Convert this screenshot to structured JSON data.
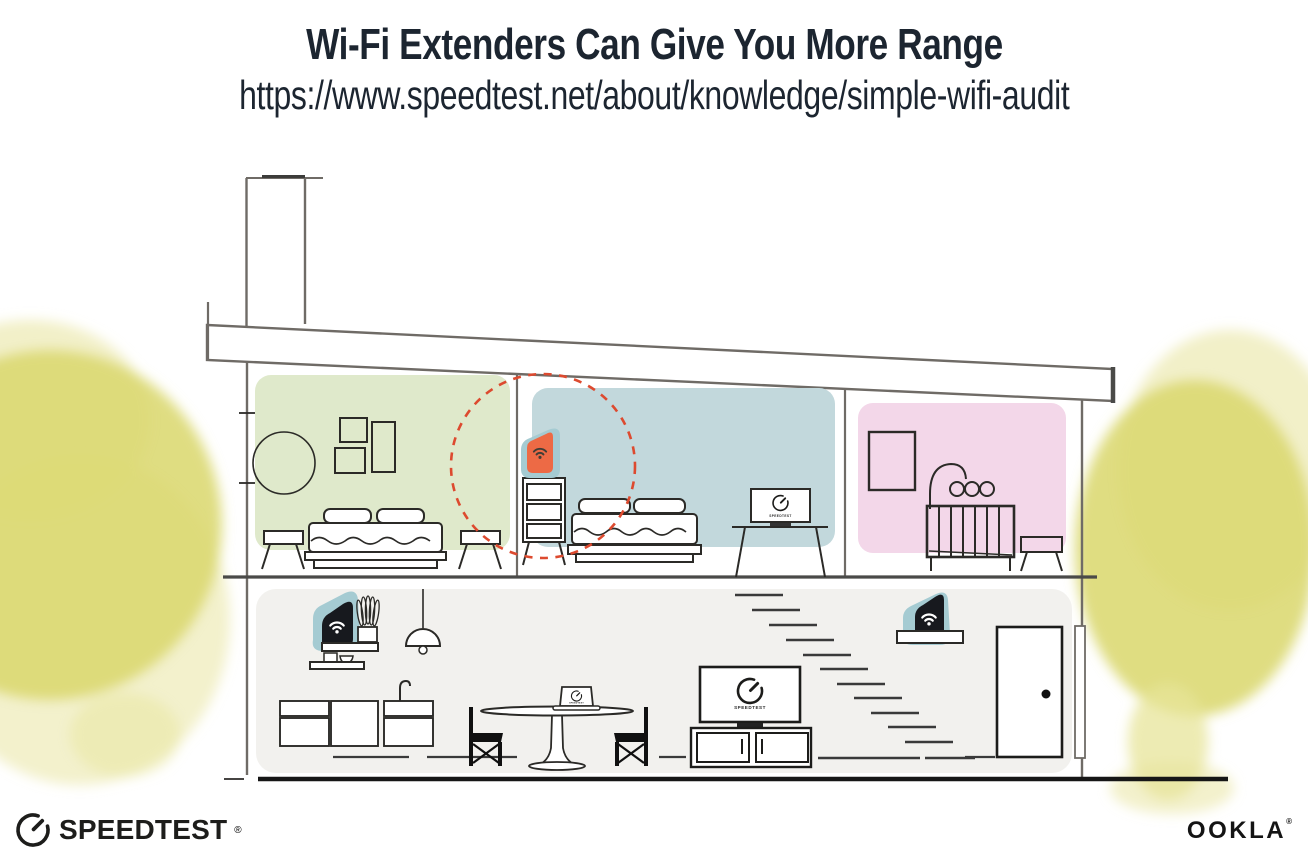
{
  "header": {
    "title": "Wi-Fi Extenders Can Give You More Range",
    "url": "https://www.speedtest.net/about/knowledge/simple-wifi-audit"
  },
  "devices": {
    "screen_label": "SPEEDTEST"
  },
  "footer": {
    "speedtest_logo": "SPEEDTEST",
    "speedtest_mark": "®",
    "ookla_logo": "OOKLA",
    "ookla_mark": "®"
  },
  "colors": {
    "title_text": "#1c2530",
    "line_gray": "#6f6b66",
    "line_dark": "#2b2a27",
    "ink_black": "#161616",
    "room_green": "#dfe9cb",
    "room_blue": "#c2d8dc",
    "room_pink": "#f3d7e9",
    "floor_gray": "#f2f1ee",
    "extender_teal": "#a5cbd2",
    "extender_orange": "#ed6a45",
    "device_black": "#17191e",
    "dashed_red": "#dd4a2f",
    "tree_yellow": "#dbd870",
    "tree_yellow_light": "#e7e49a"
  }
}
